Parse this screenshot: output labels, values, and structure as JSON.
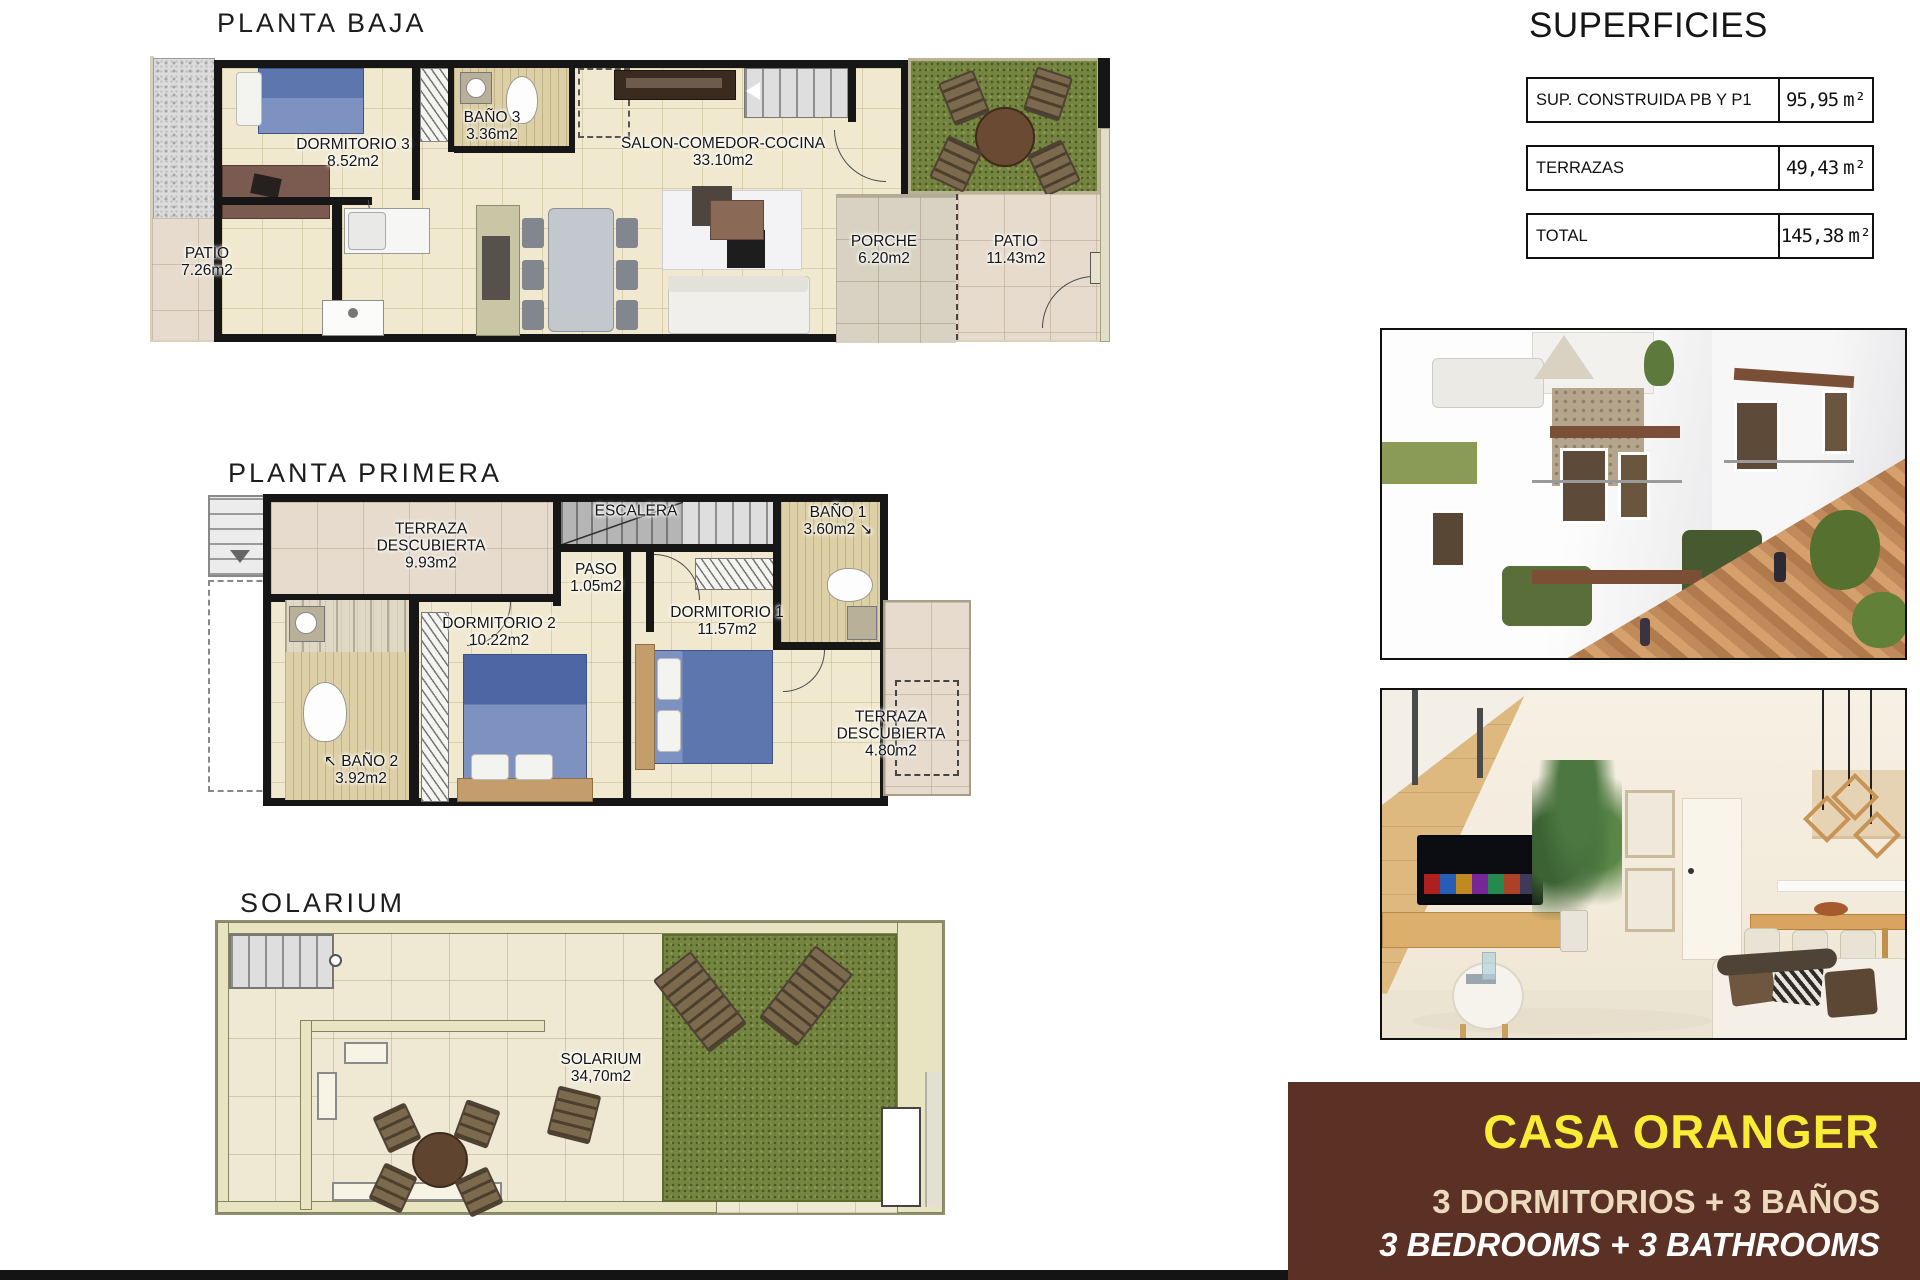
{
  "titles": {
    "baja": "PLANTA BAJA",
    "primera": "PLANTA PRIMERA",
    "solarium": "SOLARIUM"
  },
  "rooms": {
    "dorm3": {
      "n": "DORMITORIO 3",
      "a": "8.52m2"
    },
    "bano3": {
      "n": "BAÑO 3",
      "a": "3.36m2"
    },
    "salon": {
      "n": "SALON-COMEDOR-COCINA",
      "a": "33.10m2"
    },
    "patio_izq": {
      "n": "PATIO",
      "a": "7.26m2"
    },
    "porche": {
      "n": "PORCHE",
      "a": "6.20m2"
    },
    "patio_der": {
      "n": "PATIO",
      "a": "11.43m2"
    },
    "terraza1": {
      "n": "TERRAZA",
      "n2": "DESCUBIERTA",
      "a": "9.93m2"
    },
    "escalera": {
      "n": "ESCALERA",
      "a": ""
    },
    "paso": {
      "n": "PASO",
      "a": "1.05m2"
    },
    "bano1": {
      "n": "BAÑO 1",
      "a": "3.60m2 ↘"
    },
    "dorm2": {
      "n": "DORMITORIO 2",
      "a": "10.22m2"
    },
    "dorm1": {
      "n": "DORMITORIO 1",
      "a": "11.57m2"
    },
    "bano2": {
      "n": "↖ BAÑO 2",
      "a": "3.92m2"
    },
    "terraza2": {
      "n": "TERRAZA",
      "n2": "DESCUBIERTA",
      "a": "4.80m2"
    },
    "solarium": {
      "n": "SOLARIUM",
      "a": "34,70m2"
    }
  },
  "superficies": {
    "title": "SUPERFICIES",
    "rows": [
      {
        "label": "SUP. CONSTRUIDA PB Y P1",
        "value": "95,95",
        "unit": "m²"
      },
      {
        "label": "TERRAZAS",
        "value": "49,43",
        "unit": "m²"
      },
      {
        "label": "TOTAL",
        "value": "145,38",
        "unit": "m²"
      }
    ]
  },
  "property": {
    "name": "CASA ORANGER",
    "features_es": "3 DORMITORIOS + 3 BAÑOS",
    "features_en": "3 BEDROOMS + 3 BATHROOMS"
  },
  "colors": {
    "brand_bg": "#5b3126",
    "brand_title": "#f8ec35",
    "brand_text_es": "#ecdabd",
    "brand_text_en": "#ffffff",
    "wall": "#161616",
    "tile_cream": "#f1e9cf",
    "tile_patio": "#e6dbcc",
    "grass": "#75853f",
    "bed_blue": "#5d77ae"
  }
}
